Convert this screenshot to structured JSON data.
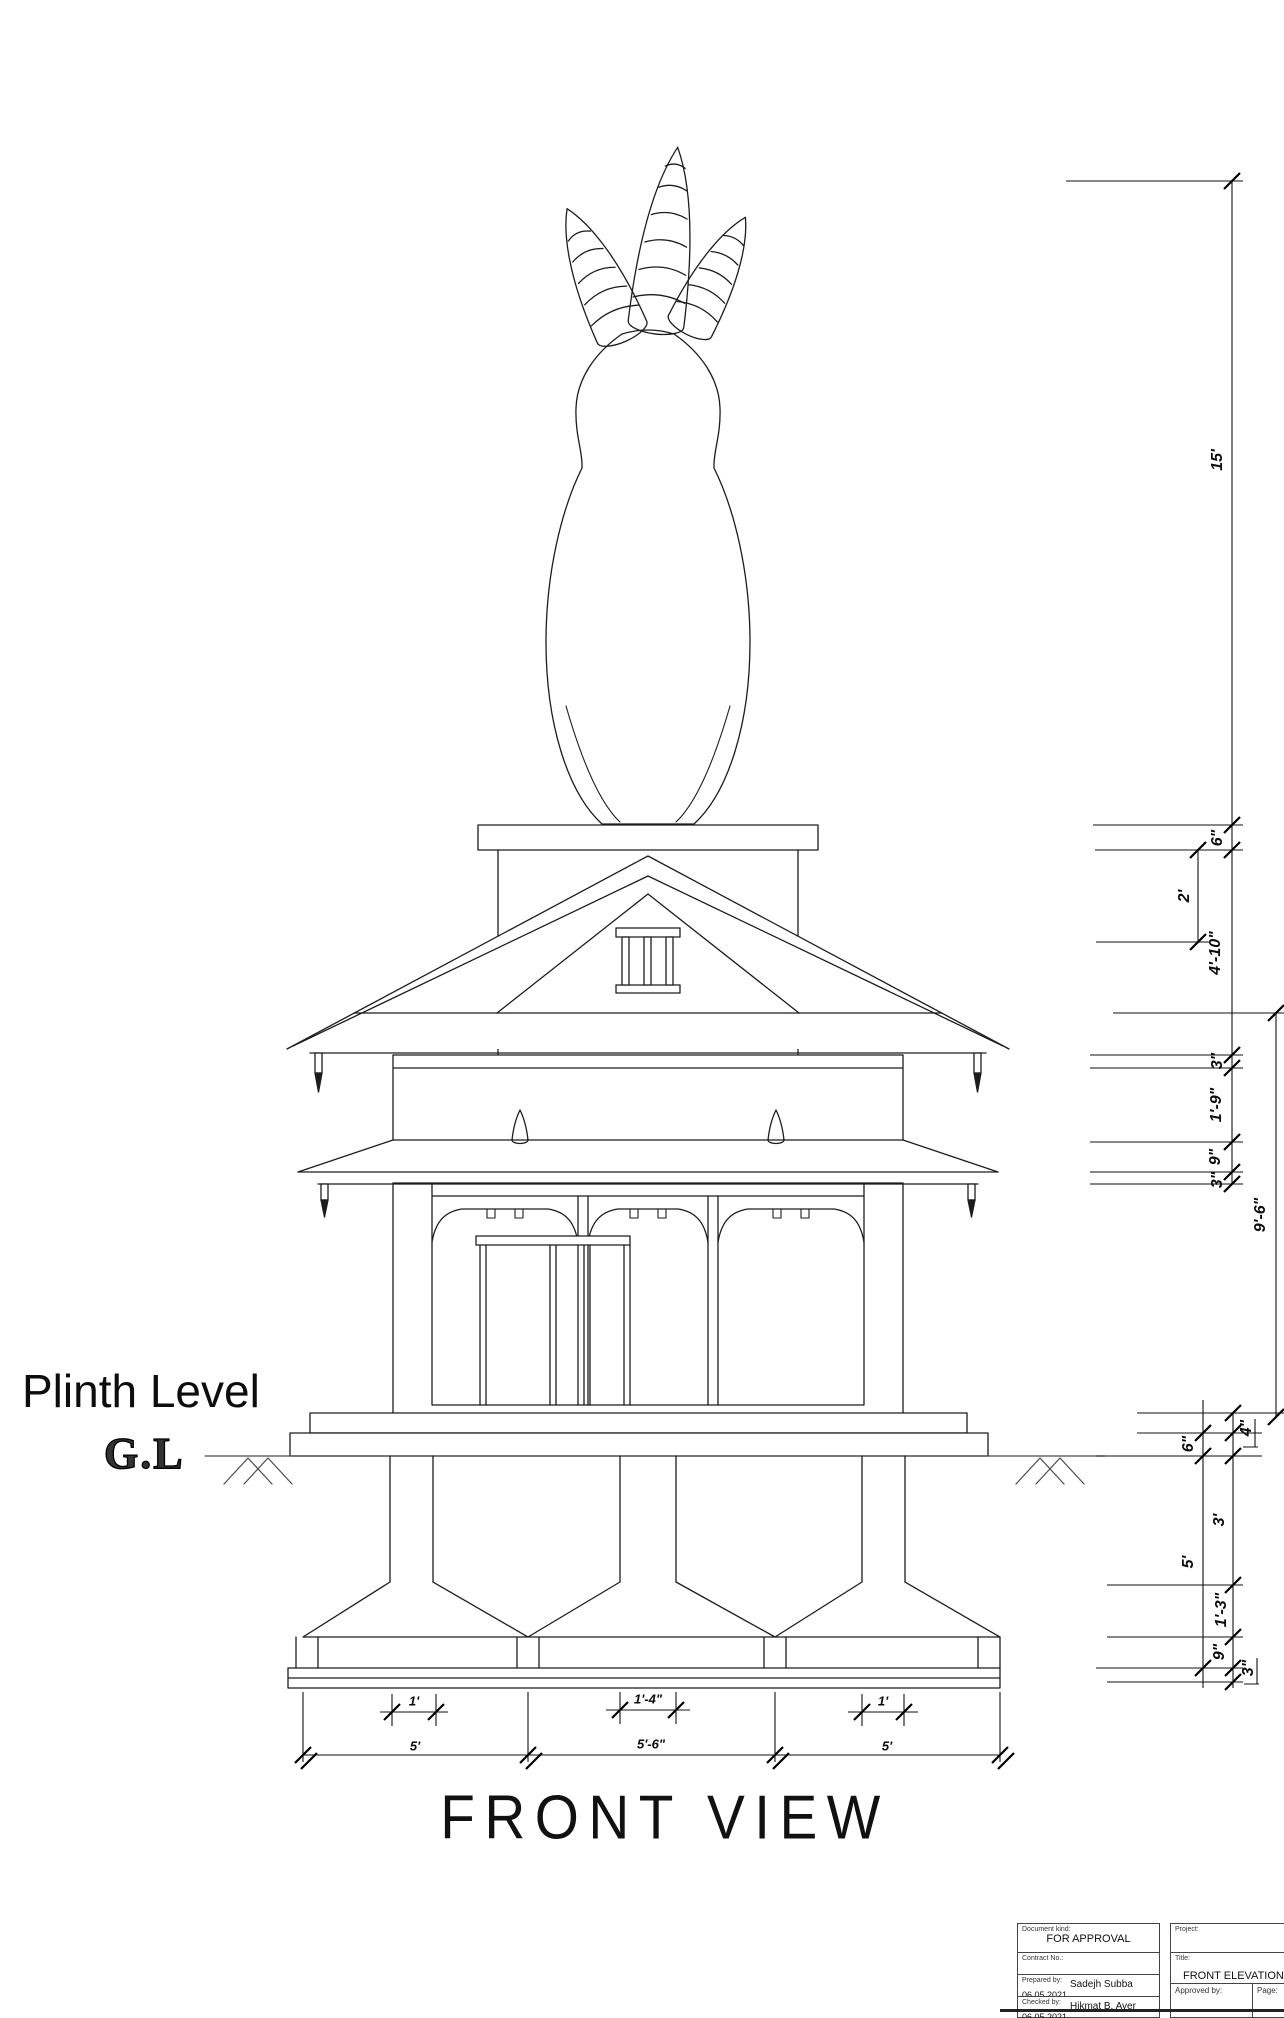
{
  "labels": {
    "plinth_level": "Plinth Level",
    "ground_level": "G.L"
  },
  "view_title": "FRONT VIEW",
  "dims_right": {
    "h15": "15'",
    "h6a": "6\"",
    "h2": "2'",
    "h4_10": "4'-10\"",
    "h3a": "3\"",
    "h1_9": "1'-9\"",
    "h9a": "9\"",
    "h3b": "3\"",
    "h9_6": "9'-6\"",
    "h4in": "4\"",
    "h6b": "6\"",
    "h3ft": "3'",
    "h5ft": "5'",
    "h1_3": "1'-3\"",
    "h9b": "9\"",
    "h3c": "3\""
  },
  "dims_bottom": {
    "w1a": "1'",
    "w1_4": "1'-4\"",
    "w1b": "1'",
    "w5a": "5'",
    "w5_6": "5'-6\"",
    "w5b": "5'"
  },
  "title_block": {
    "document_kind_label": "Document kind:",
    "document_kind_value": "FOR APPROVAL",
    "contract_label": "Contract No.:",
    "prepared_label": "Prepared by:",
    "prepared_date": "06.05.2021",
    "prepared_value": "Sadejh Subba",
    "checked_label": "Checked by:",
    "checked_date": "06.05.2021",
    "checked_value": "Hikmat B. Ayer",
    "project_label": "Project:",
    "title_label": "Title:",
    "title_value": "FRONT ELEVATION",
    "approved_label": "Approved by:",
    "page_label": "Page:"
  }
}
